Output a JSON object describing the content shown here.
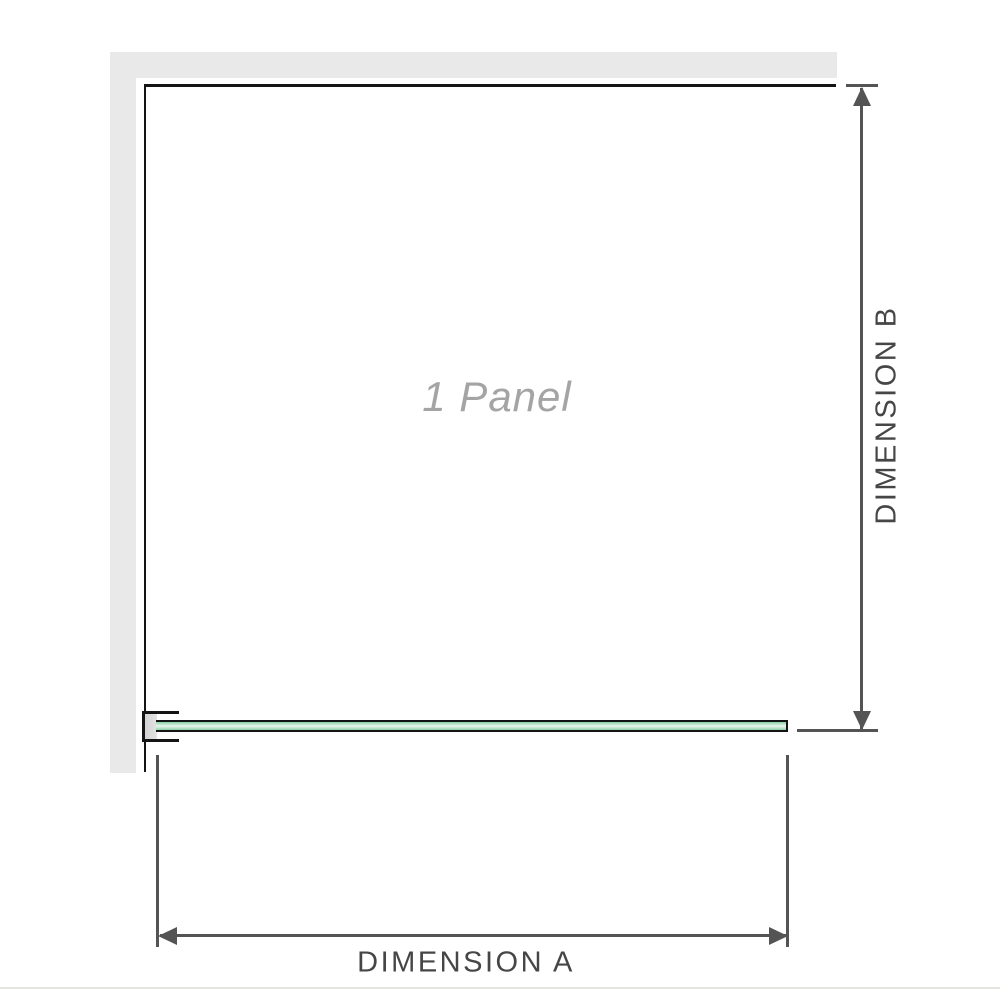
{
  "diagram": {
    "panel_label": "1 Panel",
    "dimensions": {
      "horizontal": "DIMENSION A",
      "vertical": "DIMENSION B"
    }
  },
  "icons": {
    "arrow_up": "dimension-b-arrow-up-icon",
    "arrow_down": "dimension-b-arrow-down-icon",
    "arrow_left": "dimension-a-arrow-left-icon",
    "arrow_right": "dimension-a-arrow-right-icon"
  },
  "colors": {
    "background": "#ffffff",
    "wall": "#e9e9e9",
    "outline": "#141414",
    "dimension_line": "#545454",
    "dimension_text": "#464646",
    "panel_text": "#a4a4a4",
    "glass_green_dark": "#8ed1a7",
    "glass_green_mid": "#b7e3c7",
    "glass_green_light": "#eaf7ef",
    "bracket_fill": "#ffffff",
    "bracket_insert": "#d2d2d2",
    "footer_divider": "#e4e6e0"
  }
}
